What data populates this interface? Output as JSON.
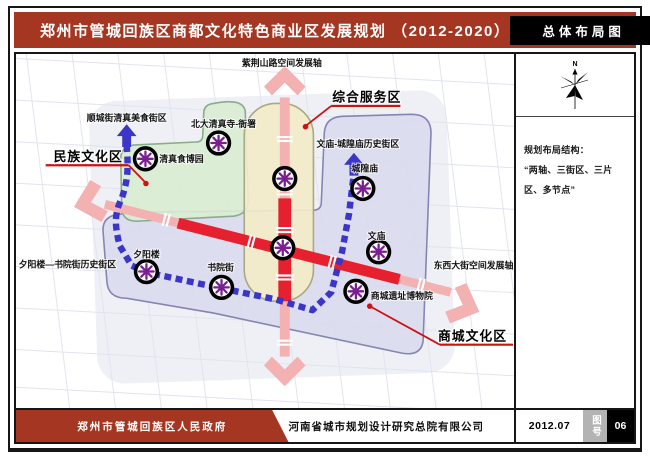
{
  "header": {
    "title": "郑州市管城回族区商都文化特色商业区发展规划 （2012-2020）",
    "badge": "总体布局图"
  },
  "map": {
    "labels": {
      "axis_north": "紫荆山路空间发展轴",
      "axis_east": "东西大街空间发展轴",
      "district_minzu": "民族文化区",
      "district_zonghe": "综合服务区",
      "district_shangcheng": "商城文化区",
      "street_shuncheng": "顺城街清真美食街区",
      "street_wenmiao": "文庙-城隍庙历史街区",
      "street_xiyanglou": "夕阳楼—书院街历史街区",
      "node_beida": "北大清真寺-衙署",
      "node_qingzhen": "清真食博园",
      "node_chenghuang": "城隍庙",
      "node_wenmiao": "文庙",
      "node_xiyanglou": "夕阳楼",
      "node_shuyuan": "书院街",
      "node_shangcheng": "商城遗址博物院"
    }
  },
  "sidebar": {
    "compass_label": "N",
    "structure_title": "规划布局结构：",
    "structure_text": "“两轴、三街区、三片区、多节点”"
  },
  "footer": {
    "government": "郑州市管城回族区人民政府",
    "company": "河南省城市规划设计研究总院有限公司",
    "date": "2012.07",
    "figure_label": "图号",
    "figure_number": "06"
  },
  "colors": {
    "header_red": "#A53722",
    "axis_red": "#E6202E",
    "axis_pink": "#F3B1B1",
    "route_blue": "#3B35C8",
    "node_purple": "#7A1F8F",
    "zone_green": "#D9ECD3",
    "zone_yellow": "#F2ECC9",
    "zone_lavender": "#D9D9EF",
    "callout_red": "#CC1212"
  }
}
